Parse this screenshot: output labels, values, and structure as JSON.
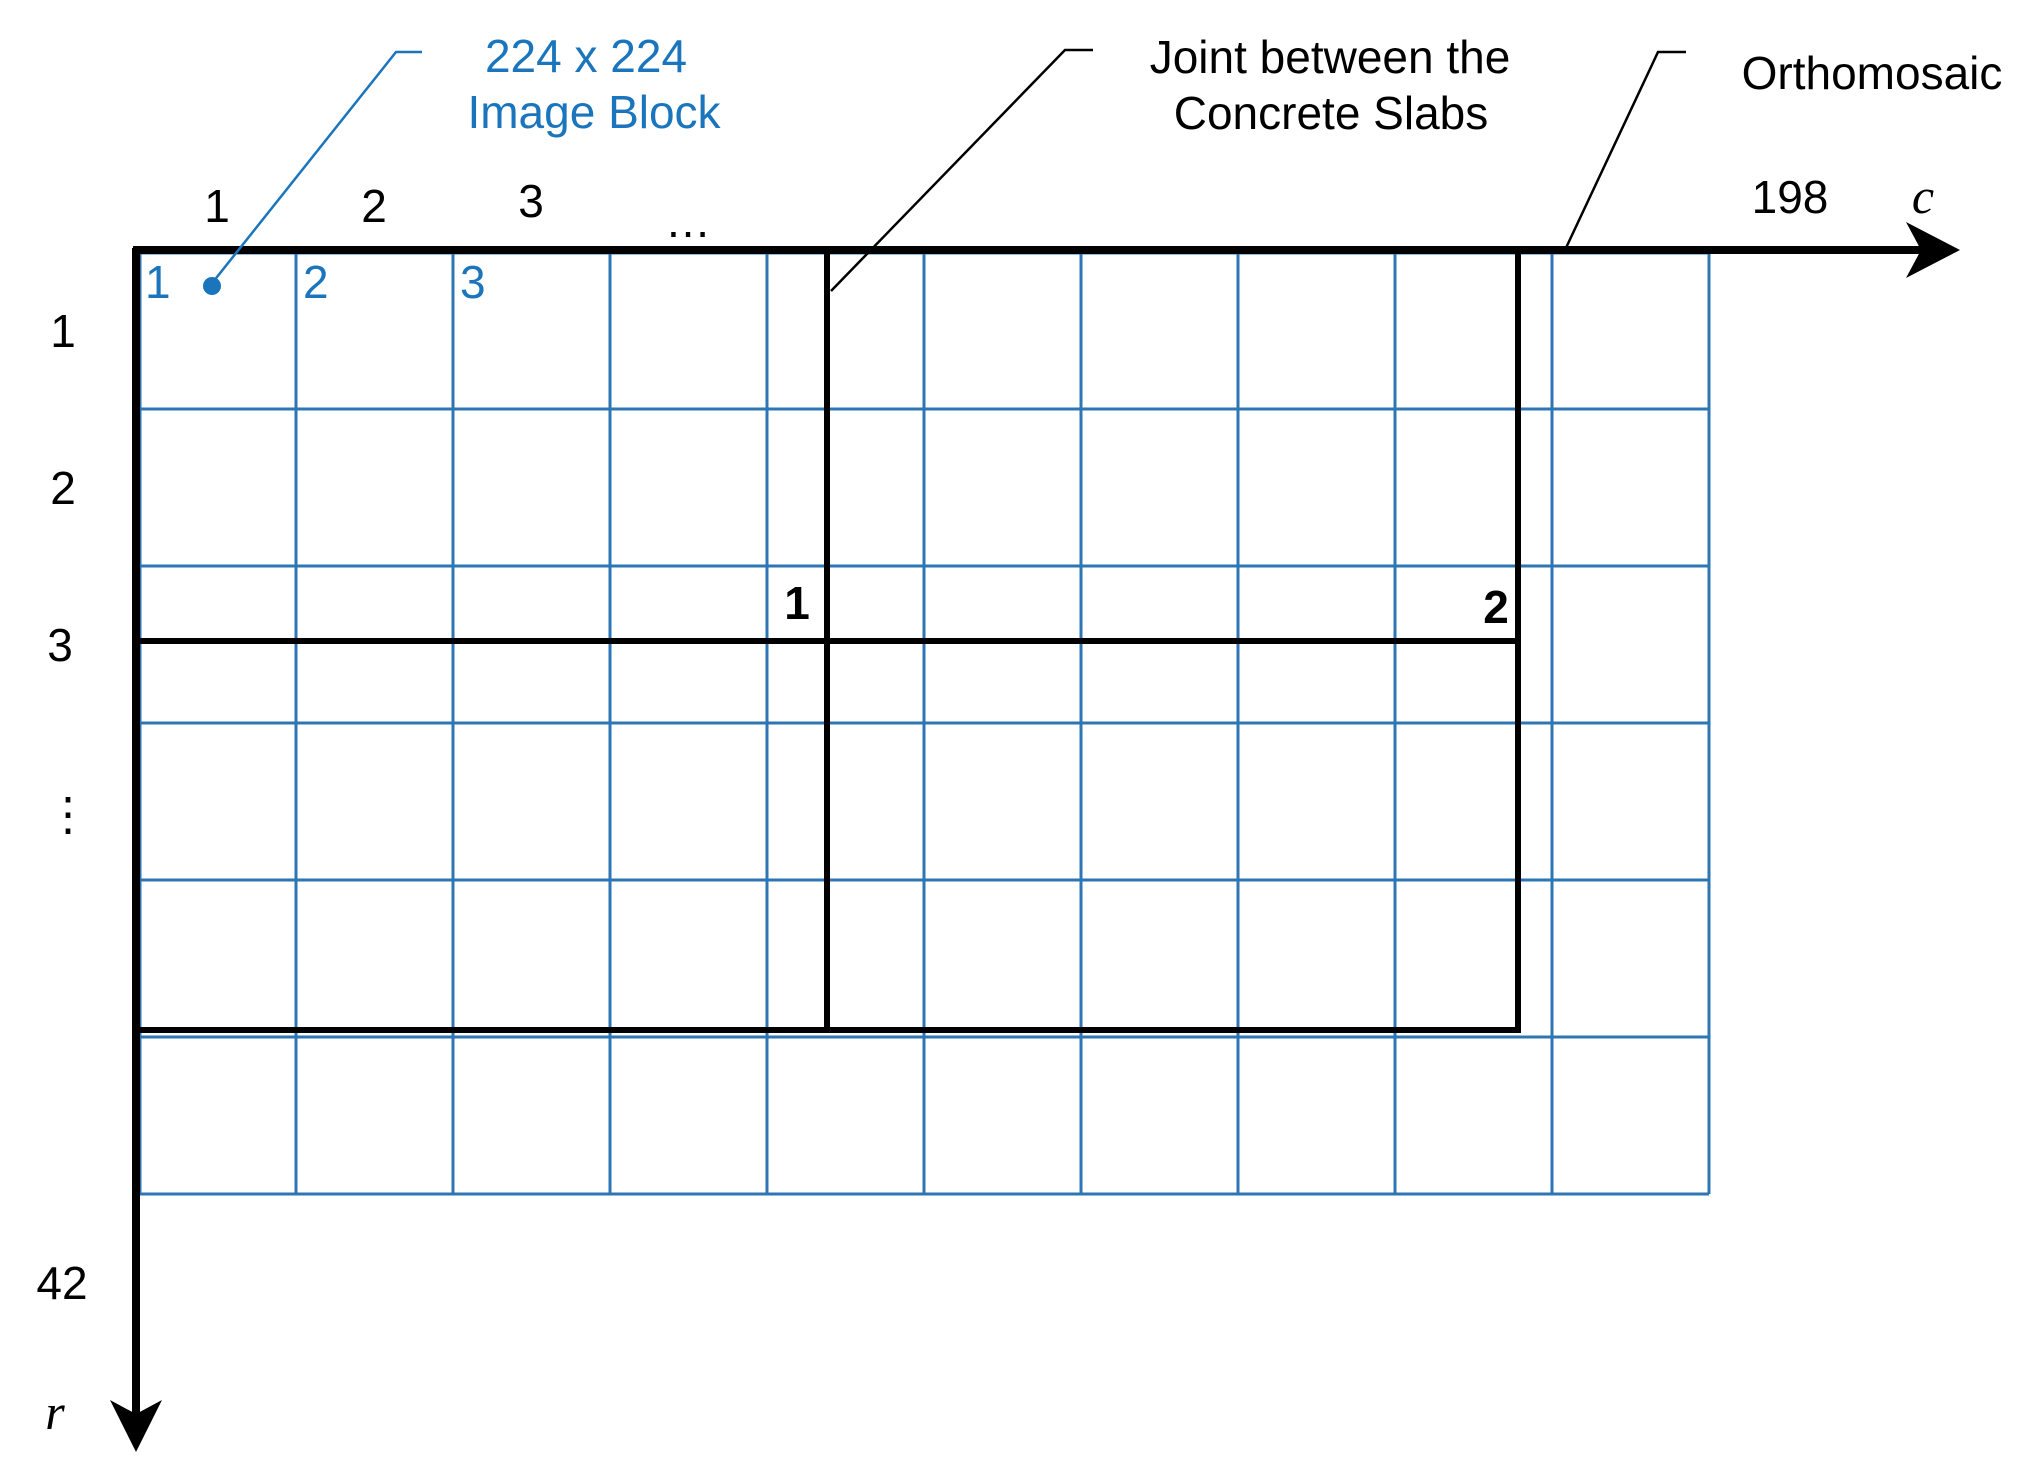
{
  "colors": {
    "annotation_blue": "#1B75BC",
    "grid_blue": "#2E75B6",
    "line_black": "#000000"
  },
  "block_annotation": {
    "line1": "224 x 224",
    "line2": "Image Block"
  },
  "joint_annotation": {
    "line1": "Joint between the",
    "line2": "Concrete Slabs"
  },
  "orthomosaic_annotation": "Orthomosaic",
  "c_axis": {
    "ticks": [
      "1",
      "2",
      "3",
      "…",
      "198"
    ],
    "label": "c"
  },
  "r_axis": {
    "ticks": [
      "1",
      "2",
      "3",
      "⋮",
      "42"
    ],
    "label": "r"
  },
  "image_block_numbers": [
    "1",
    "2",
    "3"
  ],
  "joint_numbers": [
    "1",
    "2"
  ]
}
